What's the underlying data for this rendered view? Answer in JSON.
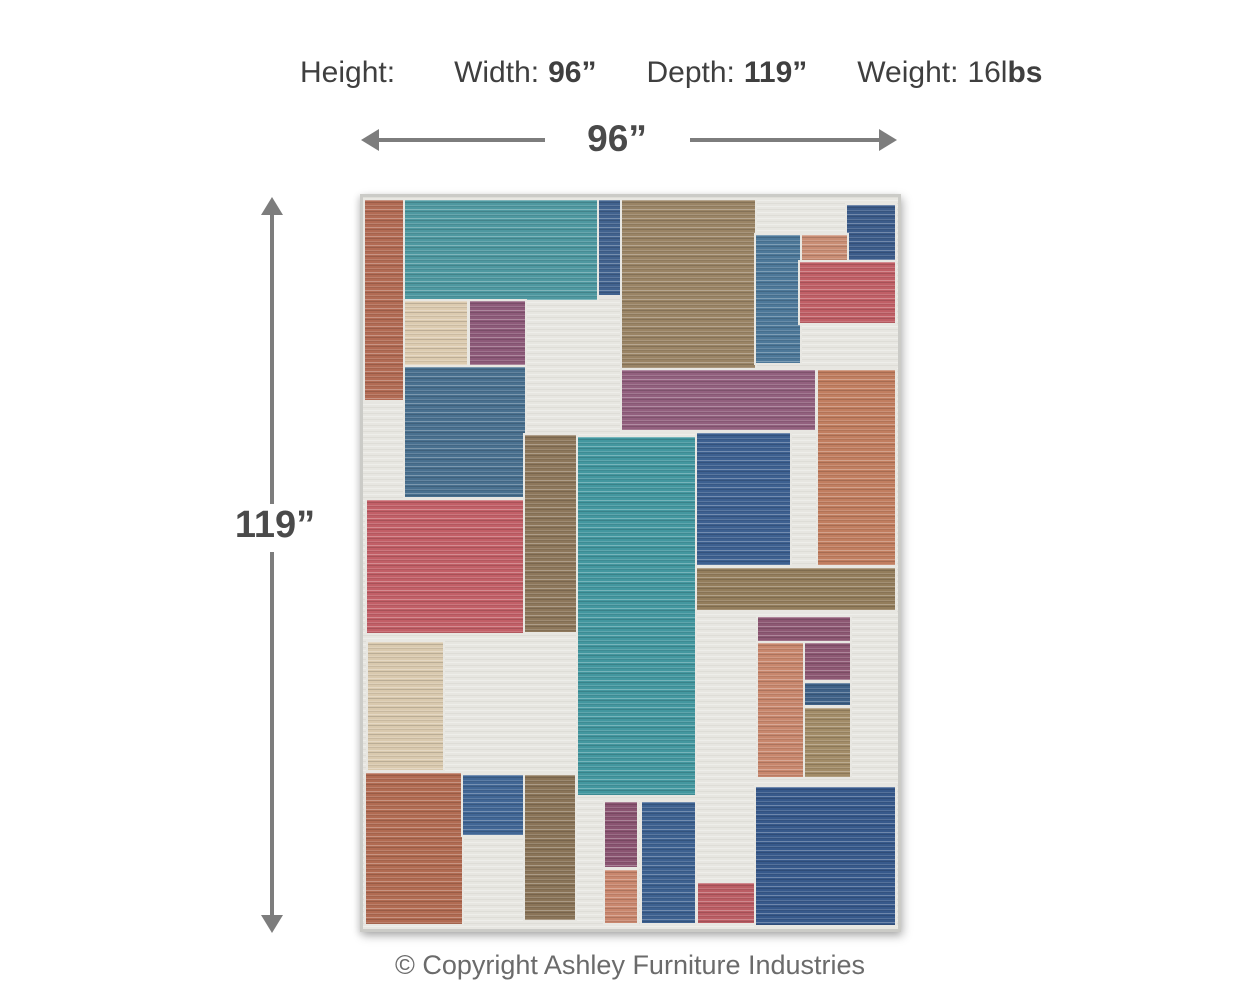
{
  "header": {
    "dimensions": [
      {
        "label": "Height:",
        "regular": "",
        "bold": ""
      },
      {
        "label": "Width:",
        "regular": "",
        "bold": "96”"
      },
      {
        "label": "Depth:",
        "regular": "",
        "bold": "119”"
      },
      {
        "label": "Weight:",
        "regular": "16l",
        "bold": "bs"
      }
    ]
  },
  "width_annotation": {
    "value": "96”"
  },
  "height_annotation": {
    "value": "119”"
  },
  "footer": {
    "copyright": "© Copyright Ashley Furniture Industries"
  },
  "colors": {
    "text_color": "#3f3f3f",
    "measure_color": "#4a4a4a",
    "arrow_color": "#7d7d7d",
    "copyright_color": "#6b6b6b",
    "rug_bg": "#e7e6e1"
  },
  "rug": {
    "description": "multicolor geometric patchwork area rug",
    "blocks": [
      {
        "name": "rust-strip-top-left",
        "x": 2,
        "y": 3,
        "w": 40,
        "h": 200,
        "c": "#b26b54"
      },
      {
        "name": "teal-top",
        "x": 42,
        "y": 3,
        "w": 192,
        "h": 100,
        "c": "#4e98a0"
      },
      {
        "name": "navy-strip-top",
        "x": 236,
        "y": 3,
        "w": 21,
        "h": 95,
        "c": "#41628e"
      },
      {
        "name": "brown-big-top",
        "x": 259,
        "y": 3,
        "w": 133,
        "h": 168,
        "c": "#9a8465"
      },
      {
        "name": "navy-corner-top-right",
        "x": 484,
        "y": 8,
        "w": 48,
        "h": 55,
        "c": "#3c5c8a"
      },
      {
        "name": "steelblue-strip-top-right",
        "x": 393,
        "y": 38,
        "w": 44,
        "h": 128,
        "c": "#4d7899"
      },
      {
        "name": "salmon-small-top-right",
        "x": 439,
        "y": 38,
        "w": 45,
        "h": 27,
        "c": "#c98d74"
      },
      {
        "name": "red-top-right",
        "x": 437,
        "y": 65,
        "w": 95,
        "h": 61,
        "c": "#c05f66"
      },
      {
        "name": "beige-mid-left",
        "x": 42,
        "y": 104,
        "w": 62,
        "h": 64,
        "c": "#dccbb0"
      },
      {
        "name": "purple-mid-left",
        "x": 107,
        "y": 104,
        "w": 55,
        "h": 64,
        "c": "#8d5a79"
      },
      {
        "name": "steelblue-mid-left",
        "x": 42,
        "y": 170,
        "w": 120,
        "h": 130,
        "c": "#49708f"
      },
      {
        "name": "plum-band-mid",
        "x": 259,
        "y": 173,
        "w": 193,
        "h": 60,
        "c": "#92607e"
      },
      {
        "name": "orange-right",
        "x": 455,
        "y": 173,
        "w": 77,
        "h": 195,
        "c": "#c17e60"
      },
      {
        "name": "red-big-left",
        "x": 4,
        "y": 303,
        "w": 158,
        "h": 133,
        "c": "#c25f67"
      },
      {
        "name": "brown-strip-mid",
        "x": 162,
        "y": 238,
        "w": 52,
        "h": 197,
        "c": "#8d775b"
      },
      {
        "name": "teal-center",
        "x": 215,
        "y": 240,
        "w": 117,
        "h": 358,
        "c": "#43979f"
      },
      {
        "name": "navy-mid-right",
        "x": 334,
        "y": 236,
        "w": 93,
        "h": 132,
        "c": "#3d6090"
      },
      {
        "name": "brown-band-right",
        "x": 334,
        "y": 371,
        "w": 198,
        "h": 42,
        "c": "#937d5c"
      },
      {
        "name": "plum-band-bottom-right",
        "x": 395,
        "y": 420,
        "w": 92,
        "h": 26,
        "c": "#8d5873"
      },
      {
        "name": "salmon-vert-bottom-right",
        "x": 395,
        "y": 446,
        "w": 47,
        "h": 134,
        "c": "#c8876d"
      },
      {
        "name": "plum-small-bottom-right",
        "x": 442,
        "y": 446,
        "w": 45,
        "h": 37,
        "c": "#8d5873"
      },
      {
        "name": "navy-small-bottom-right",
        "x": 442,
        "y": 486,
        "w": 45,
        "h": 22,
        "c": "#3f6288"
      },
      {
        "name": "tan-block-bottom-right",
        "x": 442,
        "y": 511,
        "w": 45,
        "h": 69,
        "c": "#a28c68"
      },
      {
        "name": "tan-strip-bottom-left",
        "x": 5,
        "y": 445,
        "w": 75,
        "h": 128,
        "c": "#d9c9ae"
      },
      {
        "name": "terracotta-bottom-left",
        "x": 3,
        "y": 576,
        "w": 96,
        "h": 151,
        "c": "#b16b52"
      },
      {
        "name": "blue-bottom-left",
        "x": 100,
        "y": 578,
        "w": 60,
        "h": 60,
        "c": "#416695"
      },
      {
        "name": "brown-strip-bottom-left",
        "x": 162,
        "y": 578,
        "w": 50,
        "h": 145,
        "c": "#8a7458"
      },
      {
        "name": "plum-bottom-center",
        "x": 242,
        "y": 605,
        "w": 32,
        "h": 65,
        "c": "#8a5471"
      },
      {
        "name": "salmon-bottom-center",
        "x": 242,
        "y": 673,
        "w": 32,
        "h": 53,
        "c": "#c9876e"
      },
      {
        "name": "blue-bottom-center",
        "x": 279,
        "y": 605,
        "w": 53,
        "h": 121,
        "c": "#3d6190"
      },
      {
        "name": "crimson-bottom-center",
        "x": 335,
        "y": 686,
        "w": 59,
        "h": 40,
        "c": "#bb5d64"
      },
      {
        "name": "navy-big-bottom-right",
        "x": 393,
        "y": 590,
        "w": 139,
        "h": 138,
        "c": "#37598b"
      }
    ]
  }
}
